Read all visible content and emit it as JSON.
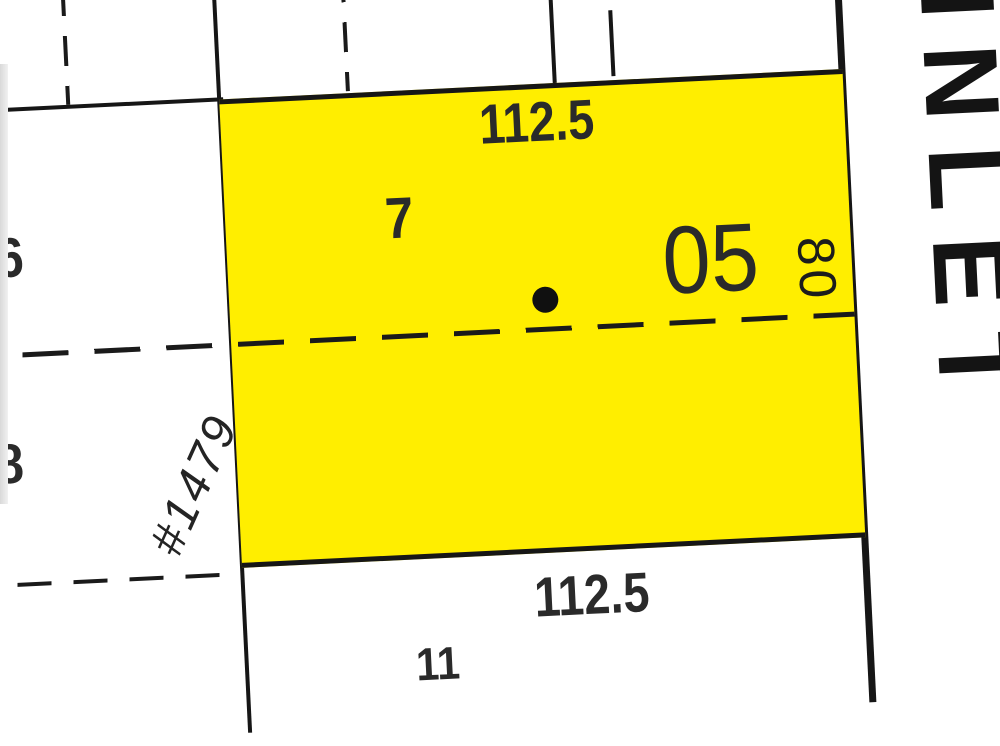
{
  "map": {
    "highlight_color": "#ffee00",
    "line_color": "#161616",
    "parcel": {
      "lot_number": "7",
      "parcel_id": "05",
      "frontage_top": "112.5",
      "frontage_bottom": "112.5",
      "depth_right": "80"
    },
    "address_label": "#1479",
    "street_label": "INLET",
    "neighbor_lots": {
      "west_upper": "6",
      "west_lower": "8",
      "south": "11"
    }
  }
}
